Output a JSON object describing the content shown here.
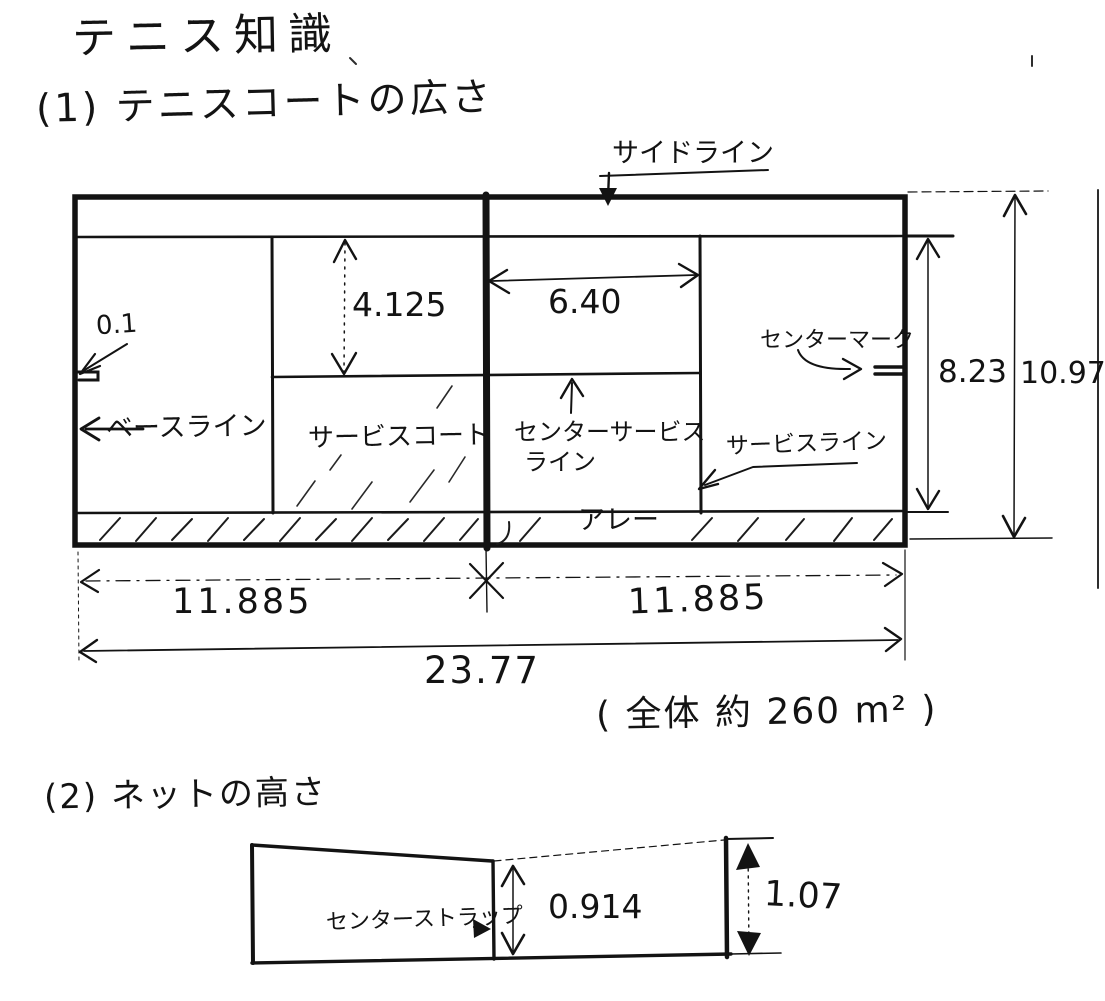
{
  "title": "テニス知識",
  "section1": {
    "heading": "(1) テニスコートの広さ",
    "labels": {
      "sideline": "サイドライン",
      "baseline": "ベースライン",
      "service_court": "サービスコート",
      "center_service_line_1": "センターサービス",
      "center_service_line_2": "ライン",
      "center_mark": "センターマーク",
      "service_line": "サービスライン",
      "alley": "アレー"
    },
    "dims": {
      "service_box_halfwidth": "4.125",
      "service_line_distance": "6.40",
      "center_mark_length": "0.1",
      "singles_width": "8.23",
      "doubles_width": "10.97",
      "half_length_left": "11.885",
      "half_length_right": "11.885",
      "total_length": "23.77"
    },
    "area_note": "( 全体 約 260 m² )"
  },
  "section2": {
    "heading": "(2) ネットの高さ",
    "labels": {
      "center_strap": "センターストラップ"
    },
    "dims": {
      "net_center_height": "0.914",
      "net_post_height": "1.07"
    }
  },
  "ink_color": "#131313"
}
